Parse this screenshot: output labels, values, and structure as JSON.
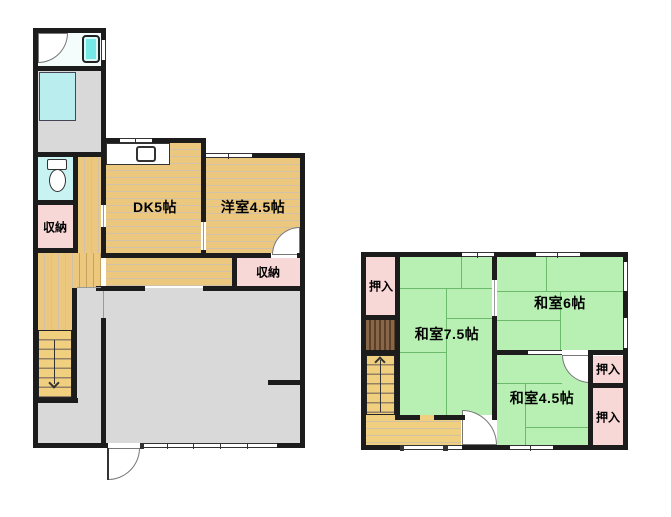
{
  "floor1": {
    "rooms": {
      "dk": "DK5帖",
      "western": "洋室4.5帖",
      "storage_left": "収納",
      "storage_right": "収納"
    }
  },
  "floor2": {
    "rooms": {
      "j75": "和室7.5帖",
      "j6": "和室6帖",
      "j45": "和室4.5帖",
      "closet_top_left": "押入",
      "closet_right_upper": "押入",
      "closet_right_lower": "押入"
    }
  },
  "icons": {
    "bathtub": "bathtub-icon",
    "toilet": "toilet-icon",
    "kitchen_sink": "kitchen-sink-icon",
    "stairs_down_arrow": "stairs-down-arrow-icon",
    "stairs_up_arrow": "stairs-up-arrow-icon"
  },
  "colors": {
    "wall": "#1c1c1c",
    "wood": "#ecc87f",
    "wood2": "#f0cf7f",
    "tatami": "#b7f0b2",
    "closet_pink": "#f8d7d7",
    "gray": "#d9d9d9",
    "bath_cyan": "#76e8e8",
    "toilet_cyan": "#c9f3f3",
    "wash_cyan": "#b9edee",
    "hatch_brown": "#8a6648"
  }
}
